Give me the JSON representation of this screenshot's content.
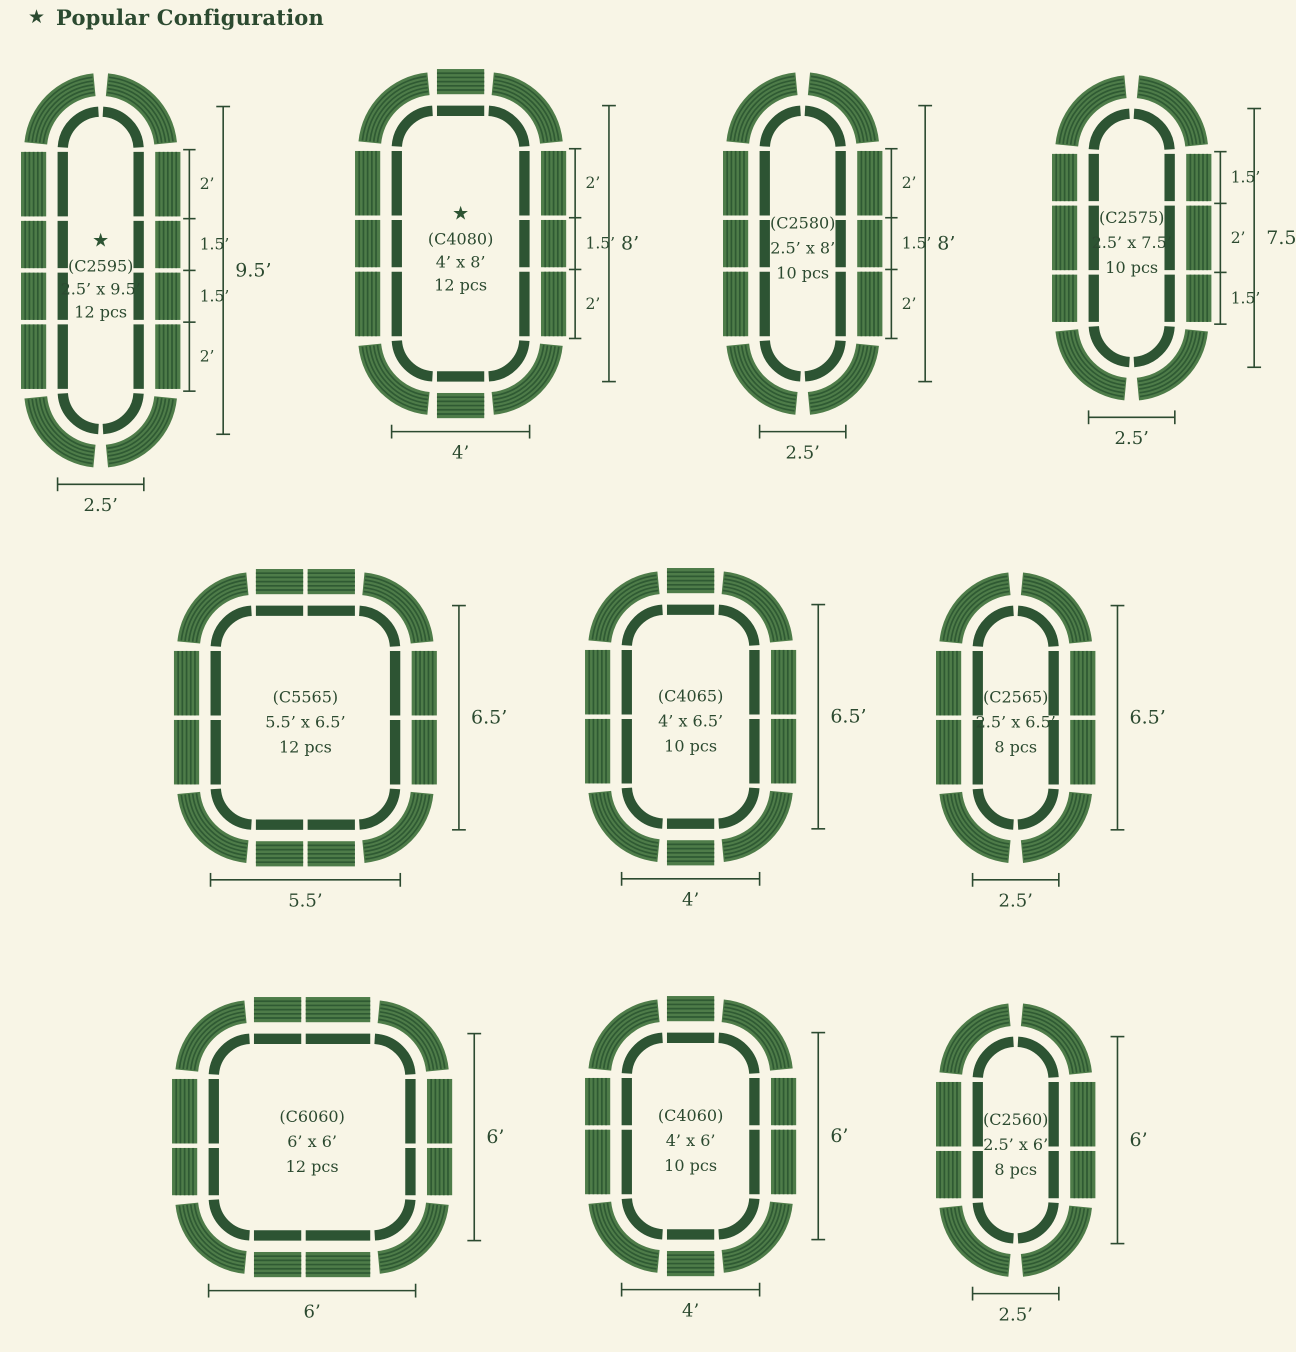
{
  "header": {
    "star_icon": "★",
    "label": "Popular Configuration"
  },
  "colors": {
    "background": "#f8f5e6",
    "panel_green": "#4e7c49",
    "stripe_green": "#2f5a33",
    "outline_green": "#2d5433",
    "dimension_green": "#2c4a30",
    "text_green": "#2c4a30"
  },
  "configs": [
    {
      "id": "C2595",
      "code": "(C2595)",
      "size": "2.5’ x 9.5’",
      "pcs": "12 pcs",
      "popular": true,
      "star": "★",
      "bed_width_ft": 2.5,
      "bed_height_ft": 9.5,
      "side_panels_ft": [
        2,
        1.5,
        1.5,
        2
      ],
      "cap_panels_ft": [],
      "side_labels": [
        "2’",
        "1.5’",
        "1.5’",
        "2’"
      ],
      "height_label": "9.5’",
      "width_label": "2.5’"
    },
    {
      "id": "C4080",
      "code": "(C4080)",
      "size": "4’ x 8’",
      "pcs": "12 pcs",
      "popular": true,
      "star": "★",
      "bed_width_ft": 4,
      "bed_height_ft": 8,
      "side_panels_ft": [
        2,
        1.5,
        2
      ],
      "cap_panels_ft": [
        1.5
      ],
      "side_labels": [
        "2’",
        "1.5’",
        "2’"
      ],
      "height_label": "8’",
      "width_label": "4’"
    },
    {
      "id": "C2580",
      "code": "(C2580)",
      "size": "2.5’ x 8’",
      "pcs": "10 pcs",
      "popular": false,
      "bed_width_ft": 2.5,
      "bed_height_ft": 8,
      "side_panels_ft": [
        2,
        1.5,
        2
      ],
      "cap_panels_ft": [],
      "side_labels": [
        "2’",
        "1.5’",
        "2’"
      ],
      "height_label": "8’",
      "width_label": "2.5’"
    },
    {
      "id": "C2575",
      "code": "(C2575)",
      "size": "2.5’ x 7.5’",
      "pcs": "10 pcs",
      "popular": false,
      "bed_width_ft": 2.5,
      "bed_height_ft": 7.5,
      "side_panels_ft": [
        1.5,
        2,
        1.5
      ],
      "cap_panels_ft": [],
      "side_labels": [
        "1.5’",
        "2’",
        "1.5’"
      ],
      "height_label": "7.5’",
      "width_label": "2.5’"
    },
    {
      "id": "C5565",
      "code": "(C5565)",
      "size": "5.5’ x 6.5’",
      "pcs": "12 pcs",
      "popular": false,
      "bed_width_ft": 5.5,
      "bed_height_ft": 6.5,
      "side_panels_ft": [
        2,
        2
      ],
      "cap_panels_ft": [
        1.5,
        1.5
      ],
      "side_labels": null,
      "height_label": "6.5’",
      "width_label": "5.5’"
    },
    {
      "id": "C4065",
      "code": "(C4065)",
      "size": "4’ x 6.5’",
      "pcs": "10 pcs",
      "popular": false,
      "bed_width_ft": 4,
      "bed_height_ft": 6.5,
      "side_panels_ft": [
        2,
        2
      ],
      "cap_panels_ft": [
        1.5
      ],
      "side_labels": null,
      "height_label": "6.5’",
      "width_label": "4’"
    },
    {
      "id": "C2565",
      "code": "(C2565)",
      "size": "2.5’ x 6.5’",
      "pcs": "8 pcs",
      "popular": false,
      "bed_width_ft": 2.5,
      "bed_height_ft": 6.5,
      "side_panels_ft": [
        2,
        2
      ],
      "cap_panels_ft": [],
      "side_labels": null,
      "height_label": "6.5’",
      "width_label": "2.5’"
    },
    {
      "id": "C6060",
      "code": "(C6060)",
      "size": "6’ x 6’",
      "pcs": "12 pcs",
      "popular": false,
      "bed_width_ft": 6,
      "bed_height_ft": 6,
      "side_panels_ft": [
        2,
        1.5
      ],
      "cap_panels_ft": [
        1.5,
        2
      ],
      "side_labels": null,
      "height_label": "6’",
      "width_label": "6’"
    },
    {
      "id": "C4060",
      "code": "(C4060)",
      "size": "4’ x 6’",
      "pcs": "10 pcs",
      "popular": false,
      "bed_width_ft": 4,
      "bed_height_ft": 6,
      "side_panels_ft": [
        1.5,
        2
      ],
      "cap_panels_ft": [
        1.5
      ],
      "side_labels": null,
      "height_label": "6’",
      "width_label": "4’"
    },
    {
      "id": "C2560",
      "code": "(C2560)",
      "size": "2.5’ x 6’",
      "pcs": "8 pcs",
      "popular": false,
      "bed_width_ft": 2.5,
      "bed_height_ft": 6,
      "side_panels_ft": [
        2,
        1.5
      ],
      "cap_panels_ft": [],
      "side_labels": null,
      "height_label": "6’",
      "width_label": "2.5’"
    }
  ]
}
